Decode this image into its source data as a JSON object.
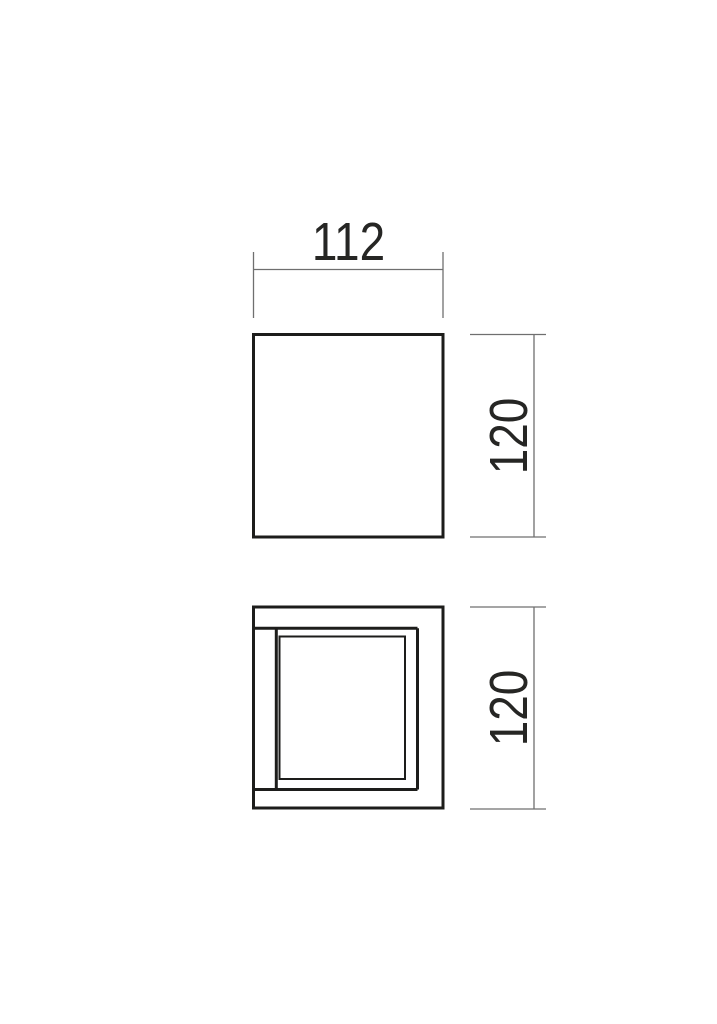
{
  "drawing": {
    "type": "product-dimension-drawing",
    "views": [
      {
        "id": "front-view",
        "description": "plain square outline (front elevation)"
      },
      {
        "id": "bottom-view",
        "description": "nested square frames (bottom / section view)"
      }
    ],
    "dimensions": [
      {
        "id": "front_width",
        "value": "112",
        "orientation": "horizontal",
        "view": "front-view"
      },
      {
        "id": "front_height",
        "value": "120",
        "orientation": "vertical",
        "view": "front-view"
      },
      {
        "id": "bottom_height",
        "value": "120",
        "orientation": "vertical",
        "view": "bottom-view"
      }
    ],
    "labels": {
      "front_width": "112",
      "front_height": "120",
      "bottom_height": "120"
    },
    "colors": {
      "object_line": "#1d1d1b",
      "dimension_line": "#6f6f6f",
      "label_text": "#262624",
      "background": "#ffffff"
    }
  }
}
